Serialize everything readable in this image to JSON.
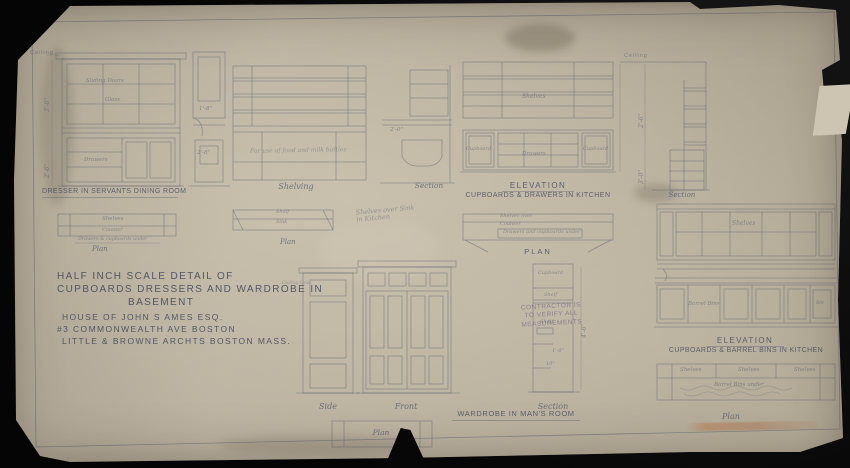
{
  "title_block": {
    "line1": "HALF INCH SCALE DETAIL OF",
    "line2": "CUPBOARDS DRESSERS AND WARDROBE IN",
    "line3": "BASEMENT",
    "line4": "HOUSE OF JOHN S AMES ESQ.",
    "line5": "#3 COMMONWEALTH AVE BOSTON",
    "line6": "LITTLE & BROWNE ARCHTS BOSTON MASS."
  },
  "stamp": {
    "line1": "CONTRACTOR IS",
    "line2": "TO VERIFY ALL",
    "line3": "MEASUREMENTS"
  },
  "misc": {
    "ceiling_left": "Ceiling"
  },
  "drawings": {
    "dresser": {
      "caption": "DRESSER IN SERVANTS DINING ROOM",
      "label_sliding_doors": "Sliding Doors",
      "label_glass": "Glass",
      "label_drawers": "Drawers",
      "dim_a": "3'-6\"",
      "dim_b": "2'-6\""
    },
    "dresser_section": {
      "dim_a": "1'-8\"",
      "dim_b": "2'-8\""
    },
    "shelving": {
      "caption": "Shelving",
      "note": "For use of food and milk bottles"
    },
    "sink_section": {
      "caption": "Section",
      "dim": "2'-0\""
    },
    "kitchen_dresser": {
      "caption1": "ELEVATION",
      "caption2": "CUPBOARDS & DRAWERS IN KITCHEN",
      "label_shelves": "Shelves",
      "label_cupboard_left": "Cupboard",
      "label_drawers": "Drawers",
      "label_cupboard_right": "Cupboard"
    },
    "kitchen_plan": {
      "caption": "PLAN",
      "label1": "Shelves over",
      "label2": "Counter",
      "label3": "Drawers and cupboards under"
    },
    "right_section": {
      "caption": "Section",
      "ceiling": "Ceiling",
      "dim_a": "2'-6\"",
      "dim_b": "3'-0\""
    },
    "dresser_plan": {
      "caption": "Plan",
      "label1": "Shelves",
      "label2": "Counter",
      "label3": "Drawers & cupboards under"
    },
    "shelving_plan": {
      "caption": "Plan",
      "label1": "Shelf",
      "label2": "Sink"
    },
    "pencil_note": {
      "line1": "Shelves over Sink",
      "line2": "in Kitchen"
    },
    "barrel_elevation": {
      "caption1": "ELEVATION",
      "caption2": "CUPBOARDS & BARREL BINS IN KITCHEN",
      "label_shelves": "Shelves",
      "label_barrel_bins": "Barrel Bins",
      "label_bin": "Bin"
    },
    "barrel_plan": {
      "caption": "Plan",
      "label_shelves1": "Shelves",
      "label_shelves2": "Shelves",
      "label_shelves3": "Shelves",
      "label_under": "Barrel Bins under"
    },
    "wardrobe": {
      "caption_side": "Side",
      "caption_front": "Front",
      "caption_section": "Section",
      "caption_main": "WARDROBE IN MAN'S ROOM",
      "caption_plan": "Plan",
      "label_ceiling_line": "Ceiling Line",
      "label_cupboard": "Cupboard",
      "label_shelf_a": "Shelf",
      "label_shelf_b": "Shelf",
      "dim_a": "1'-6\"",
      "dim_b": "10\"",
      "dim_c": "4'-6\""
    }
  },
  "colors": {
    "paper": "#b4aa99",
    "ink": "#596070",
    "stamp_purple": "#6a5a80",
    "stamp_red": "#ba6c3a",
    "background": "#050505"
  }
}
